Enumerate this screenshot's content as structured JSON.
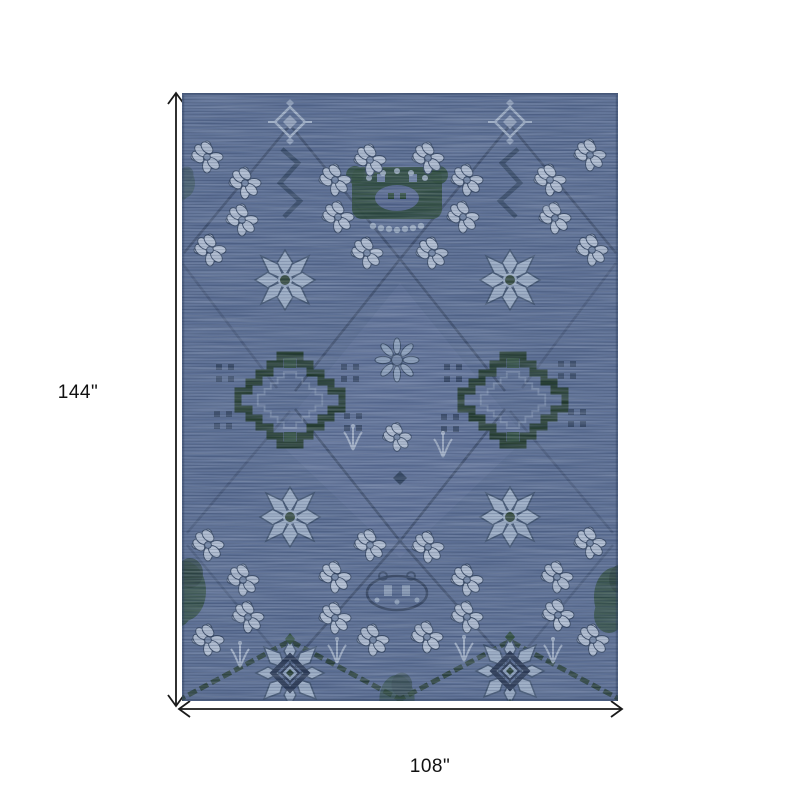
{
  "page": {
    "background": "#ffffff"
  },
  "product_diagram": {
    "height_label": "144\"",
    "width_label": "108\"",
    "rug": {
      "colors": {
        "base": "#56698f",
        "light_streak": "#8494b2",
        "dark_streak": "#3a4a68",
        "motif_light": "#b5c1d4",
        "motif_outline": "#31425d",
        "green_dark": "#1e3627",
        "green_mid": "#2b4936",
        "navy_dark": "#22304b"
      }
    }
  }
}
